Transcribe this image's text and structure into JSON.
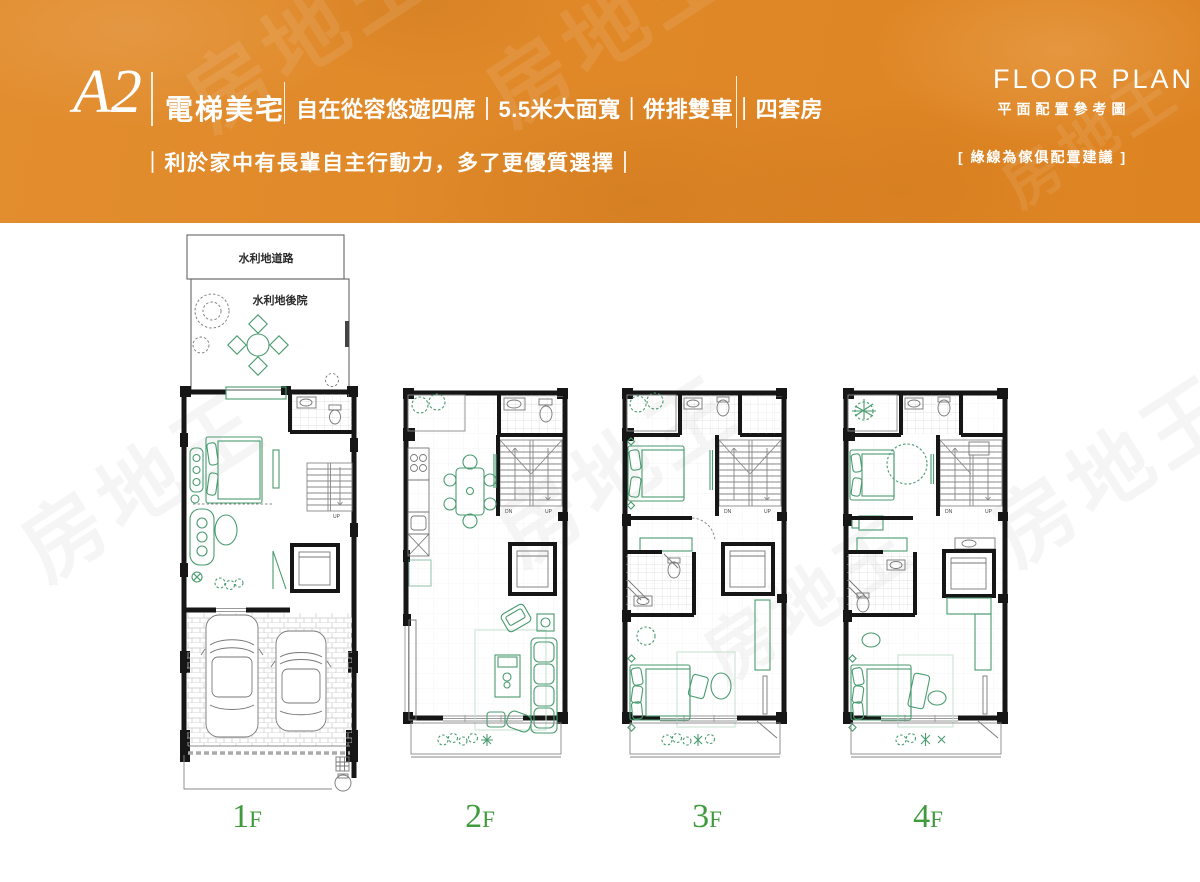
{
  "header": {
    "unit_code": "A2",
    "unit_name": "電梯美宅",
    "tagline": "自在從容悠遊四席｜5.5米大面寬｜併排雙車｜四套房",
    "subtitle": "｜利於家中有長輩自主行動力，多了更優質選擇｜",
    "plan_title_en": "FLOOR PLAN",
    "plan_title_zh": "平面配置參考圖",
    "legend_note": "[ 綠線為傢俱配置建議 ]",
    "bg_color": "#df8626",
    "text_color": "#ffffff"
  },
  "watermark": {
    "text": "房地王"
  },
  "site": {
    "road_label": "水利地道路",
    "backyard_label": "水利地後院"
  },
  "stairs": {
    "up": "UP",
    "down": "DN"
  },
  "floors": [
    {
      "id": "1f",
      "num": "1",
      "suffix": "F"
    },
    {
      "id": "2f",
      "num": "2",
      "suffix": "F"
    },
    {
      "id": "3f",
      "num": "3",
      "suffix": "F"
    },
    {
      "id": "4f",
      "num": "4",
      "suffix": "F"
    }
  ],
  "colors": {
    "furniture_green": "#4a9b70",
    "label_green": "#3f9b3c",
    "wall_black": "#161616"
  }
}
